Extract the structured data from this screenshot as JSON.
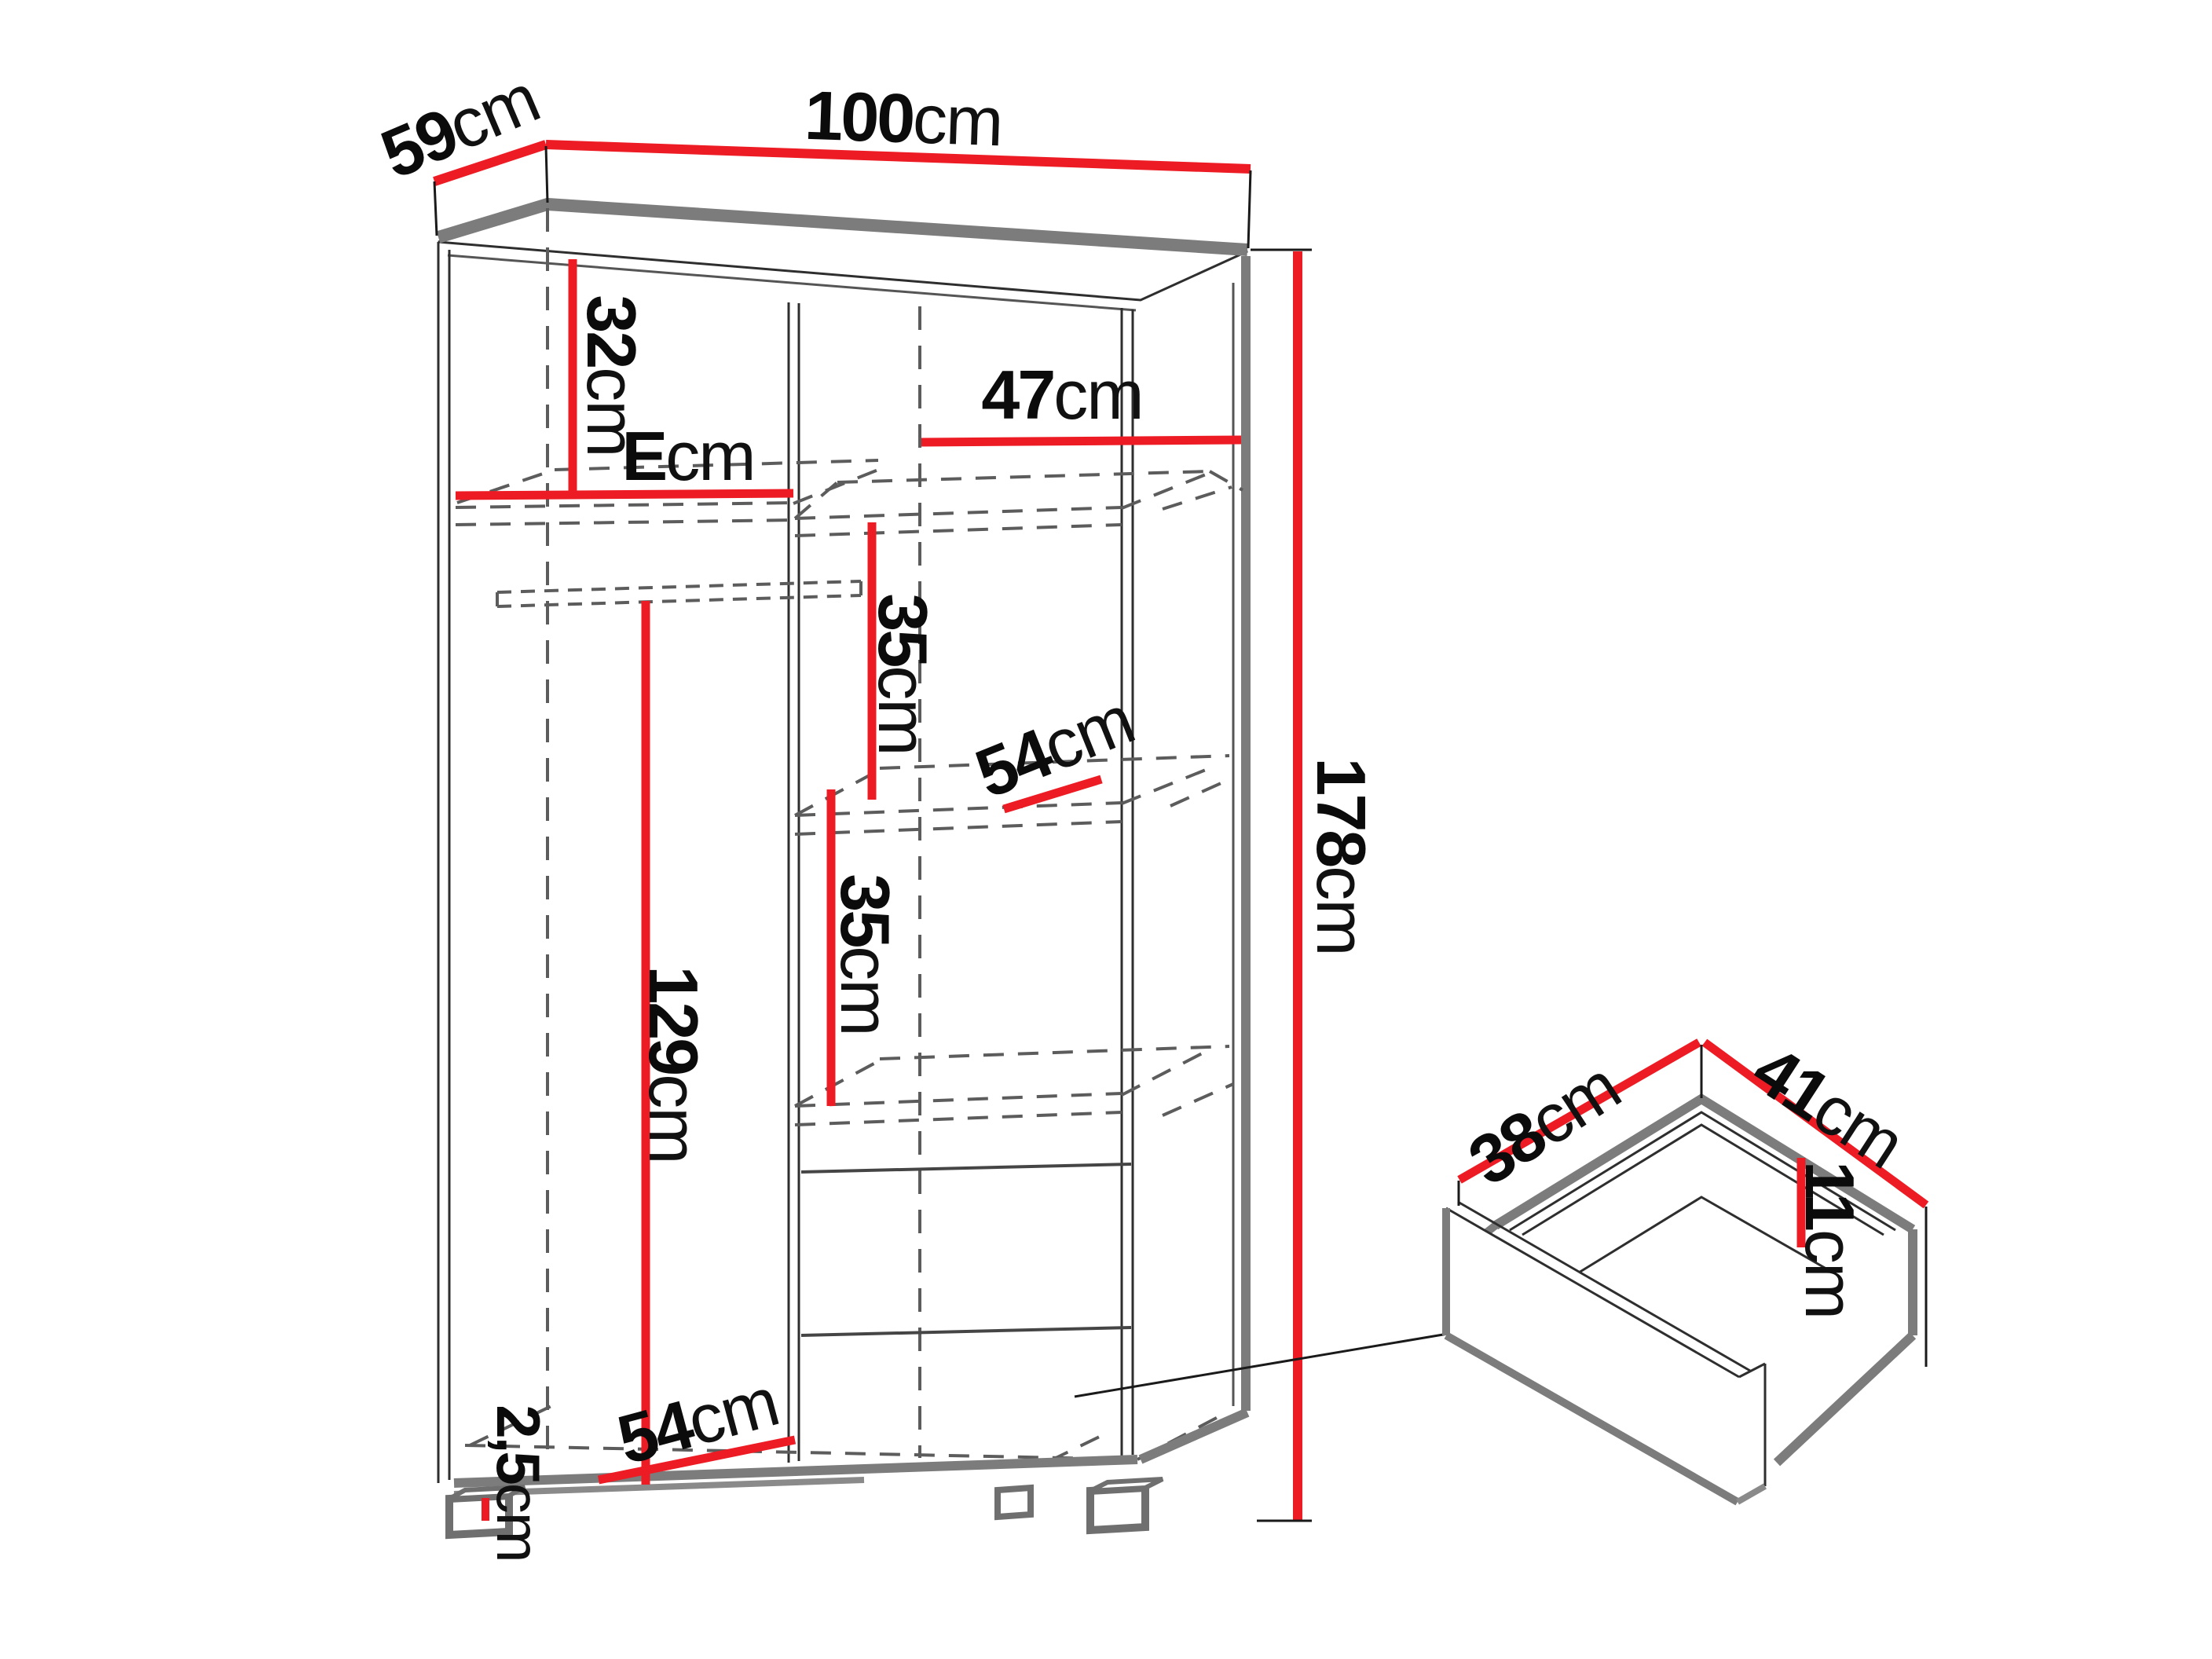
{
  "diagram_type": "furniture-dimension-diagram",
  "unit": "cm",
  "colors": {
    "dimension_line": "#ed1c24",
    "outline_dark": "#2e2e2e",
    "outline_gray": "#7c7c7c",
    "hidden_edge_dash": "#5c5c5c",
    "background": "#ffffff"
  },
  "dims": {
    "depth59": {
      "value": "59",
      "unit": "cm"
    },
    "width100": {
      "value": "100",
      "unit": "cm"
    },
    "height178": {
      "value": "178",
      "unit": "cm"
    },
    "top32": {
      "value": "32",
      "unit": "cm"
    },
    "shelfE": {
      "value": "E",
      "unit": "cm"
    },
    "shelf47": {
      "value": "47",
      "unit": "cm"
    },
    "gap35a": {
      "value": "35",
      "unit": "cm"
    },
    "gap35b": {
      "value": "35",
      "unit": "cm"
    },
    "depth54a": {
      "value": "54",
      "unit": "cm"
    },
    "depth54b": {
      "value": "54",
      "unit": "cm"
    },
    "hang129": {
      "value": "129",
      "unit": "cm"
    },
    "plinth25": {
      "value": "2,5",
      "unit": "cm"
    },
    "drawer38": {
      "value": "38",
      "unit": "cm"
    },
    "drawer41": {
      "value": "41",
      "unit": "cm"
    },
    "drawer11": {
      "value": "11",
      "unit": "cm"
    }
  }
}
